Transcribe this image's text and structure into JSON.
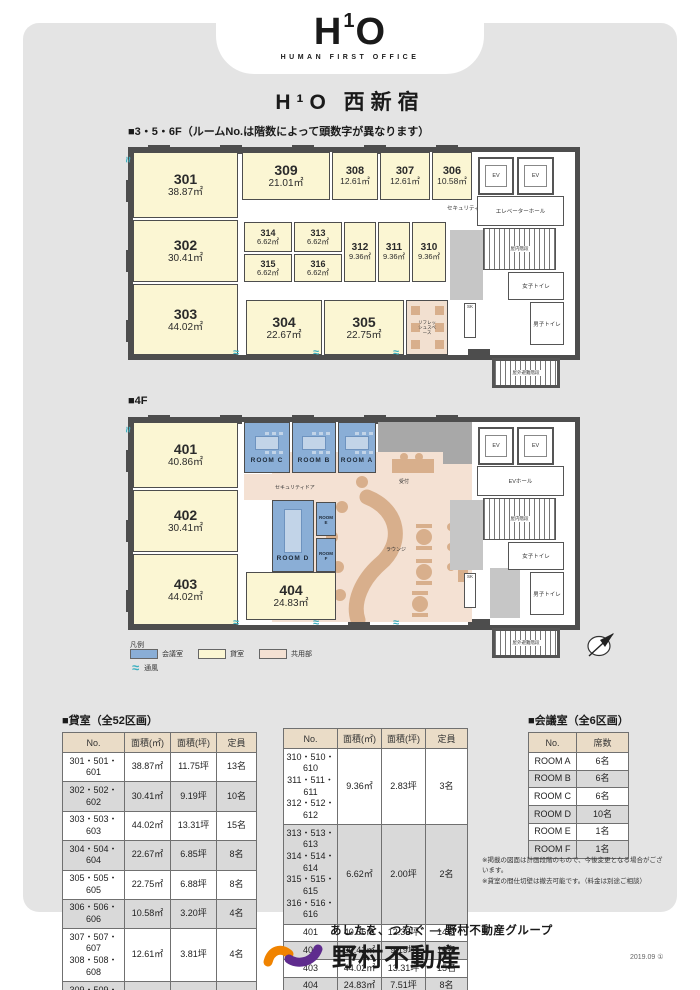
{
  "page": {
    "logo": "H¹O",
    "logo_tagline": "HUMAN FIRST OFFICE",
    "title": "H¹O 西新宿",
    "date_code": "2019.09 ①"
  },
  "icons": {
    "vent": "≈"
  },
  "colors": {
    "panel_gray": "#E4E4E4",
    "wall": "#4D4D4D",
    "rental_yellow": "#FBF6D3",
    "meeting_blue": "#8AAED6",
    "common_pink": "#F4E1D3",
    "furniture_tan": "#D8AF8C",
    "vent_teal": "#3DB0C0",
    "brand_orange": "#F08300",
    "brand_purple": "#5F2C8E"
  },
  "plan356": {
    "section_title": "■3・5・6F（ルームNo.は階数によって頭数字が異なります）",
    "rooms": {
      "r301": {
        "no": "301",
        "area": "38.87㎡"
      },
      "r302": {
        "no": "302",
        "area": "30.41㎡"
      },
      "r303": {
        "no": "303",
        "area": "44.02㎡"
      },
      "r304": {
        "no": "304",
        "area": "22.67㎡"
      },
      "r305": {
        "no": "305",
        "area": "22.75㎡"
      },
      "r306": {
        "no": "306",
        "area": "10.58㎡"
      },
      "r307": {
        "no": "307",
        "area": "12.61㎡"
      },
      "r308": {
        "no": "308",
        "area": "12.61㎡"
      },
      "r309": {
        "no": "309",
        "area": "21.01㎡"
      },
      "r310": {
        "no": "310",
        "area": "9.36㎡"
      },
      "r311": {
        "no": "311",
        "area": "9.36㎡"
      },
      "r312": {
        "no": "312",
        "area": "9.36㎡"
      },
      "r313": {
        "no": "313",
        "area": "6.62㎡"
      },
      "r314": {
        "no": "314",
        "area": "6.62㎡"
      },
      "r315": {
        "no": "315",
        "area": "6.62㎡"
      },
      "r316": {
        "no": "316",
        "area": "6.62㎡"
      }
    }
  },
  "plan4f": {
    "section_title": "■4F",
    "rooms": {
      "r401": {
        "no": "401",
        "area": "40.86㎡"
      },
      "r402": {
        "no": "402",
        "area": "30.41㎡"
      },
      "r403": {
        "no": "403",
        "area": "44.02㎡"
      },
      "r404": {
        "no": "404",
        "area": "24.83㎡"
      },
      "roomA": {
        "label": "ROOM A"
      },
      "roomB": {
        "label": "ROOM B"
      },
      "roomC": {
        "label": "ROOM C"
      },
      "roomD": {
        "label": "ROOM D"
      },
      "roomE": {
        "label": "ROOM E"
      },
      "roomF": {
        "label": "ROOM F"
      }
    }
  },
  "core": {
    "ev": "EV",
    "elevator_hall": "エレベーターホール",
    "ev_hall": "EVホール",
    "indoor_stairs": "屋内階段",
    "women_toilet": "女子トイレ",
    "men_toilet": "男子トイレ",
    "sk": "SK",
    "escape_stairs": "屋外避難階段",
    "security_door": "セキュリティドア",
    "refresh_space": "リフレッシュスペース",
    "reception": "受付",
    "lounge": "ラウンジ"
  },
  "legend": {
    "title": "凡例",
    "items": [
      {
        "label": "会議室",
        "color": "#8AAED6"
      },
      {
        "label": "貸室",
        "color": "#FBF6D3"
      },
      {
        "label": "共用部",
        "color": "#F4E1D3"
      }
    ],
    "vent_label": "通風"
  },
  "tables": {
    "rental": {
      "title": "■貸室（全52区画）",
      "headers": [
        "No.",
        "面積(㎡)",
        "面積(坪)",
        "定員"
      ],
      "left_rows": [
        [
          "301・501・601",
          "38.87㎡",
          "11.75坪",
          "13名"
        ],
        [
          "302・502・602",
          "30.41㎡",
          "9.19坪",
          "10名"
        ],
        [
          "303・503・603",
          "44.02㎡",
          "13.31坪",
          "15名"
        ],
        [
          "304・504・604",
          "22.67㎡",
          "6.85坪",
          "8名"
        ],
        [
          "305・505・605",
          "22.75㎡",
          "6.88坪",
          "8名"
        ],
        [
          "306・506・606",
          "10.58㎡",
          "3.20坪",
          "4名"
        ],
        [
          "307・507・607\n308・508・608",
          "12.61㎡",
          "3.81坪",
          "4名"
        ],
        [
          "309・509・609",
          "21.01㎡",
          "6.35坪",
          "7名"
        ]
      ],
      "right_rows": [
        [
          "310・510・610\n311・511・611\n312・512・612",
          "9.36㎡",
          "2.83坪",
          "3名"
        ],
        [
          "313・513・613\n314・514・614\n315・515・615\n316・516・616",
          "6.62㎡",
          "2.00坪",
          "2名"
        ],
        [
          "401",
          "40.86㎡",
          "12.36坪",
          "14名"
        ],
        [
          "402",
          "30.41㎡",
          "9.19坪",
          "10名"
        ],
        [
          "403",
          "44.02㎡",
          "13.31坪",
          "15名"
        ],
        [
          "404",
          "24.83㎡",
          "7.51坪",
          "8名"
        ]
      ]
    },
    "meeting": {
      "title": "■会議室（全6区画）",
      "headers": [
        "No.",
        "席数"
      ],
      "rows": [
        [
          "ROOM A",
          "6名"
        ],
        [
          "ROOM B",
          "6名"
        ],
        [
          "ROOM C",
          "6名"
        ],
        [
          "ROOM D",
          "10名"
        ],
        [
          "ROOM E",
          "1名"
        ],
        [
          "ROOM F",
          "1名"
        ]
      ]
    },
    "notes": [
      "※掲載の図面は計画段階のもので、今後変更となる場合がございます。",
      "※貸室の間仕切壁は撤去可能です。（料金は別途ご相談）"
    ]
  },
  "footer": {
    "tagline": "あしたを、つなぐ ― 野村不動産グループ",
    "company": "野村不動産"
  }
}
